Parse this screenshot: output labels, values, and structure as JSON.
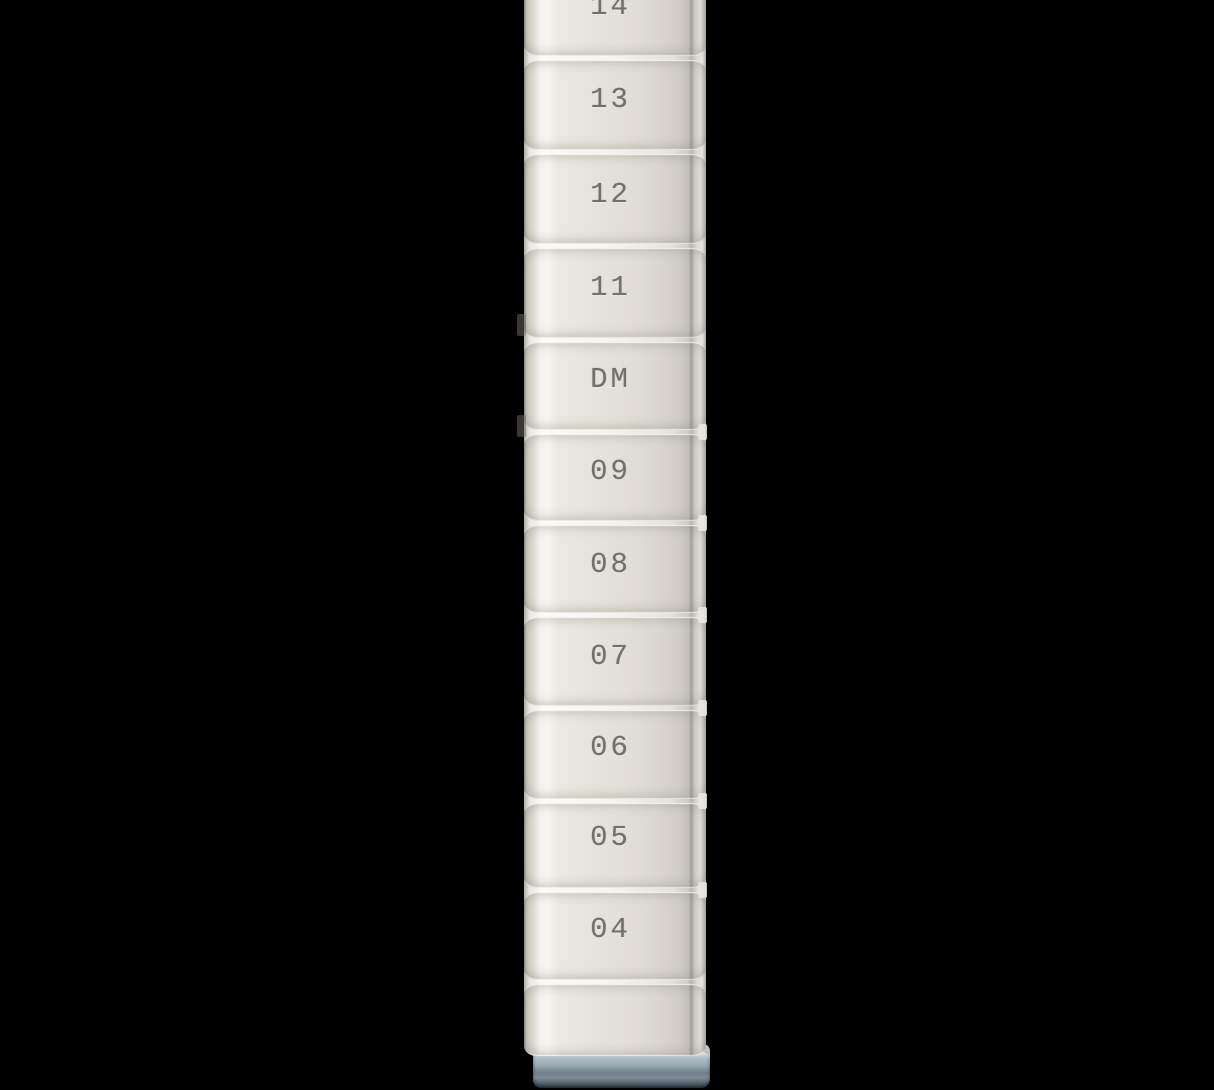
{
  "background_color": "#000000",
  "post": {
    "markings": [
      {
        "label": "14"
      },
      {
        "label": "13"
      },
      {
        "label": "12"
      },
      {
        "label": "11"
      },
      {
        "label": "DM"
      },
      {
        "label": "09"
      },
      {
        "label": "08"
      },
      {
        "label": "07"
      },
      {
        "label": "06"
      },
      {
        "label": "05"
      },
      {
        "label": "04"
      }
    ],
    "colors": {
      "body": "#e7e4dc",
      "highlight": "#f6f5f1",
      "edge_shadow": "#8a877f",
      "groove_line": "#fbfaf6",
      "stamp_text": "#686760",
      "foot_cap": "#8fa0ab"
    }
  }
}
